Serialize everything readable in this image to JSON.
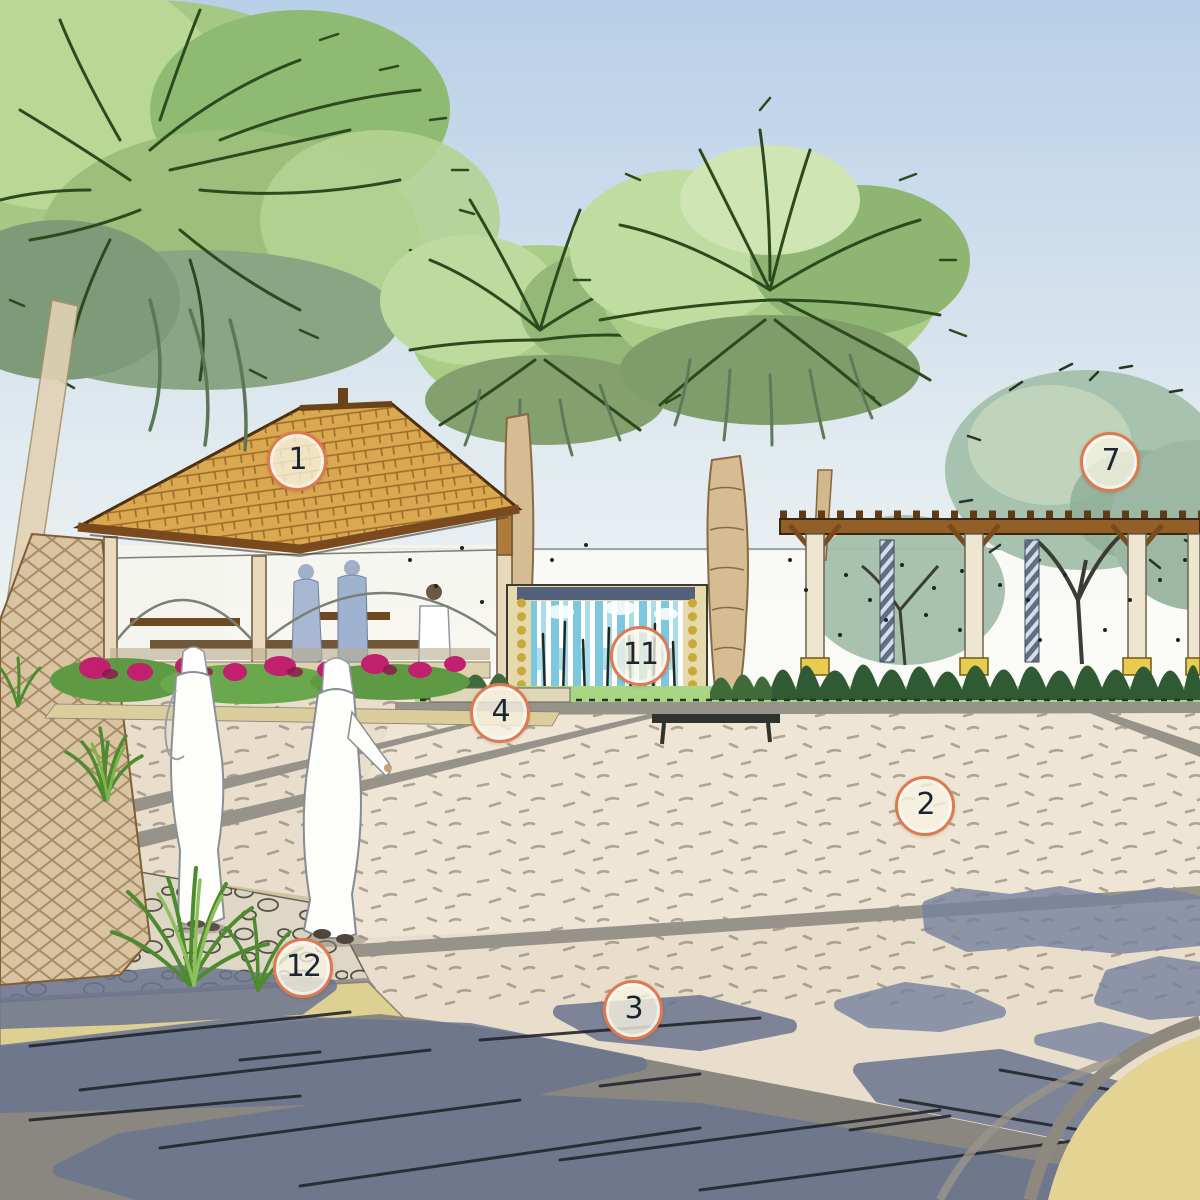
{
  "canvas": {
    "width": 1200,
    "height": 1200
  },
  "style": "hand-drawn watercolor landscape-architecture concept rendering",
  "markers": [
    {
      "label": "1",
      "x": 297,
      "y": 461,
      "feature": "gazebo-pavilion-roof"
    },
    {
      "label": "7",
      "x": 1110,
      "y": 462,
      "feature": "shade-tree-canopy"
    },
    {
      "label": "11",
      "x": 640,
      "y": 656,
      "feature": "water-feature-wall"
    },
    {
      "label": "4",
      "x": 500,
      "y": 713,
      "feature": "planter-seat-wall-edge"
    },
    {
      "label": "2",
      "x": 925,
      "y": 806,
      "feature": "plaza-paving"
    },
    {
      "label": "12",
      "x": 303,
      "y": 968,
      "feature": "street-curb"
    },
    {
      "label": "3",
      "x": 633,
      "y": 1010,
      "feature": "roadway"
    }
  ],
  "marker_style": {
    "border_color": "#dd7a50",
    "fill_color": "#f8f3e3",
    "text_color": "#1b2530",
    "diameter_px": 54
  },
  "scene": {
    "elements": [
      "sky",
      "date-palms",
      "gazebo-pavilion",
      "figures-in-white-kanduras",
      "figures-inside-gazebo",
      "flower-bed",
      "ornamental-grasses",
      "water-feature-wall",
      "pergola",
      "shade-trees",
      "hedge-and-lawn",
      "plaza-paving",
      "walkway",
      "gravel-mulch-bed",
      "curb",
      "roadway-with-tree-shadows",
      "corner-island"
    ]
  },
  "palette": {
    "sky_top": "#b8cfe8",
    "sky_horizon": "#fafaf5",
    "foliage_light": "#c0dda1",
    "foliage_mid": "#a9cc86",
    "foliage_gray": "#8aa88c",
    "roof_wood": "#d9a850",
    "wood_dark": "#6b4318",
    "palm_trunk": "#d6bc92",
    "flower_magenta": "#c0206e",
    "lawn": "#a9d584",
    "hedge": "#2f5a33",
    "plaza": "#efe5d4",
    "walkway": "#e9ddcc",
    "curb": "#ded092",
    "road": "#8a8781",
    "shadow_blue": "#6b7590",
    "water": "#7cc8de",
    "robe_white": "#fdfdfa",
    "column_cream": "#efe6d2",
    "base_yellow": "#e9cb52"
  }
}
